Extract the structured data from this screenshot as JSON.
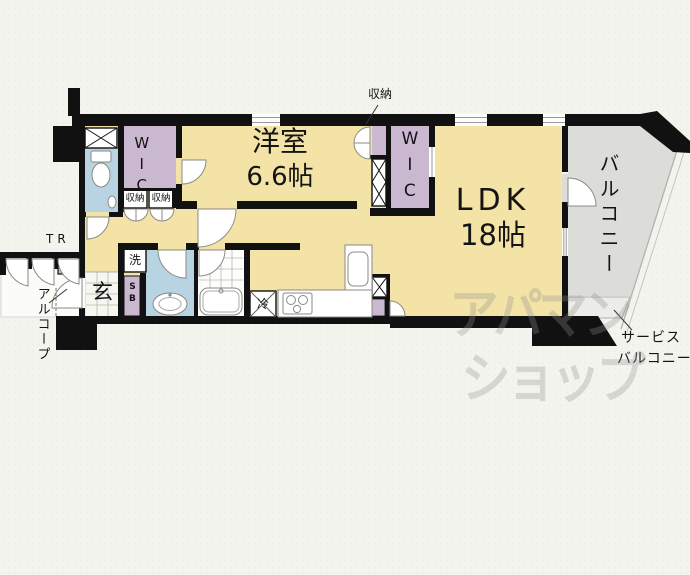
{
  "floorplan": {
    "rooms": {
      "western_room_name": "洋室",
      "western_room_size": "6.6帖",
      "ldk_name": "LDK",
      "ldk_size": "18帖",
      "wic_left": "WIC",
      "wic_right": "WIC",
      "closet_callout": "収納",
      "closet_box_left": "収納",
      "closet_box_right": "収納",
      "balcony": "バルコニー",
      "service_balcony_line1": "サービス",
      "service_balcony_line2": "バルコニー",
      "entrance": "玄",
      "washer": "洗",
      "fridge": "冷",
      "shoe_box": "SB",
      "trunk_room": "TR",
      "alcove": "アルコープ"
    },
    "watermark": {
      "line1": "アパマン",
      "line2": "ショップ"
    },
    "colors": {
      "room_beige": "#f3e3a7",
      "closet_purple": "#cab8d1",
      "wet_area_blue": "#b8d3e2",
      "balcony_gray": "#dcdcd8",
      "service_balcony_gray": "#ecece8",
      "wall_black": "#111111",
      "background": "#f4f4ef",
      "watermark_gray": "#8f8f8f"
    }
  }
}
